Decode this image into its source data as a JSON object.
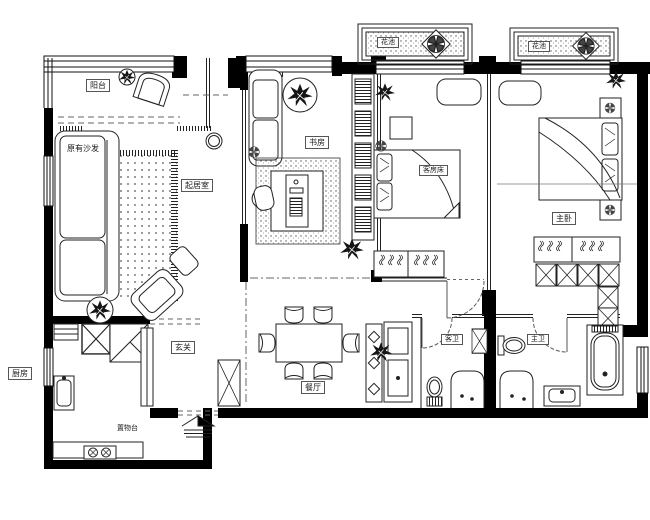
{
  "plan_type": "apartment-floor-plan",
  "colors": {
    "wall": "#000000",
    "line": "#222222",
    "bg": "#ffffff",
    "dash": "#666666"
  },
  "labels": {
    "balcony": "阳台",
    "existing_sofa": "原有沙发",
    "living_room": "起居室",
    "study": "书房",
    "guest_bed": "客房床",
    "master_bedroom": "主卧",
    "flower_bed_1": "花池",
    "flower_bed_2": "花池",
    "kitchen": "厨房",
    "storage_counter": "置物台",
    "foyer": "玄关",
    "dining_room": "餐厅",
    "guest_bathroom": "客卫",
    "master_bathroom": "主卫"
  }
}
